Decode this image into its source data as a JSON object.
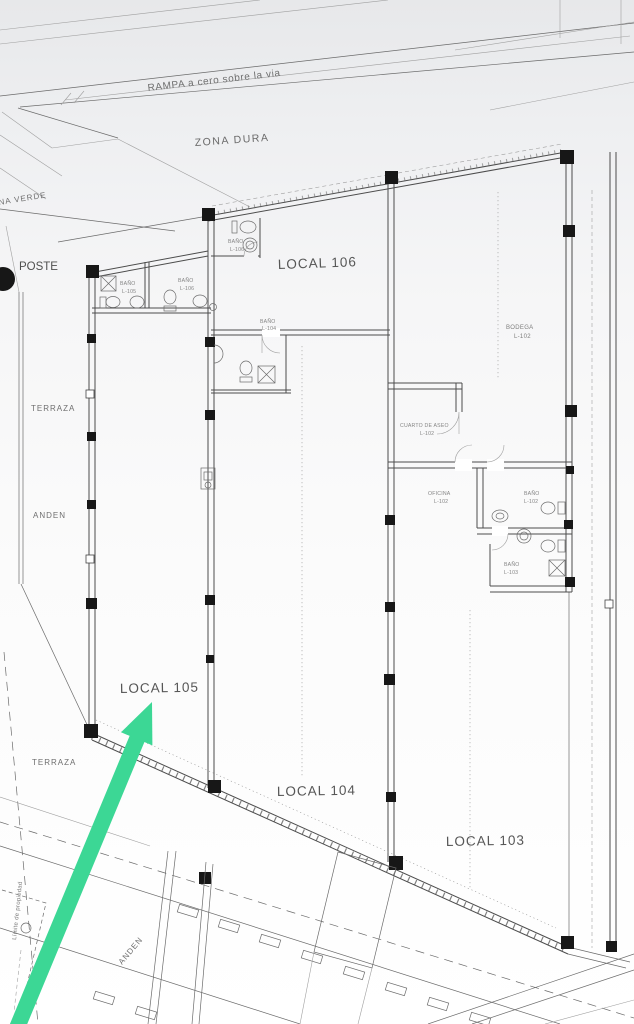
{
  "labels": {
    "rampa": "RAMPA a cero sobre la via",
    "zona_dura": "ZONA DURA",
    "zona_verde": "ZONA VERDE",
    "poste": "POSTE",
    "terraza_upper": "TERRAZA",
    "anden_upper": "ANDEN",
    "terraza_lower": "TERRAZA",
    "anden_lower": "ANDEN",
    "limite_propiedad": "Límite de propiedad",
    "local_103": "LOCAL 103",
    "local_104": "LOCAL 104",
    "local_105": "LOCAL 105",
    "local_106": "LOCAL 106"
  },
  "rooms": {
    "bodega": {
      "name": "BODEGA",
      "code": "L-102"
    },
    "cuarto_aseo": {
      "name": "CUARTO DE ASEO",
      "code": "L-102"
    },
    "oficina": {
      "name": "OFICINA",
      "code": "L-102"
    },
    "bano_102": {
      "name": "BAÑO",
      "code": "L-102"
    },
    "bano_103": {
      "name": "BAÑO",
      "code": "L-103"
    },
    "bano_104": {
      "name": "BAÑO",
      "code": "L-104"
    },
    "bano_105": {
      "name": "BAÑO",
      "code": "L-105"
    },
    "bano_106a": {
      "name": "BAÑO",
      "code": "L-106"
    },
    "bano_106b": {
      "name": "BAÑO",
      "code": "L-106"
    }
  },
  "annotation": {
    "points_to": "LOCAL 105",
    "arrow_color": "#3cd795"
  },
  "colors": {
    "arrow_green": "#3cd795",
    "paper_top": "#e7e8ea",
    "paper": "#fcfcfc",
    "line": "#555555",
    "column": "#171717"
  }
}
